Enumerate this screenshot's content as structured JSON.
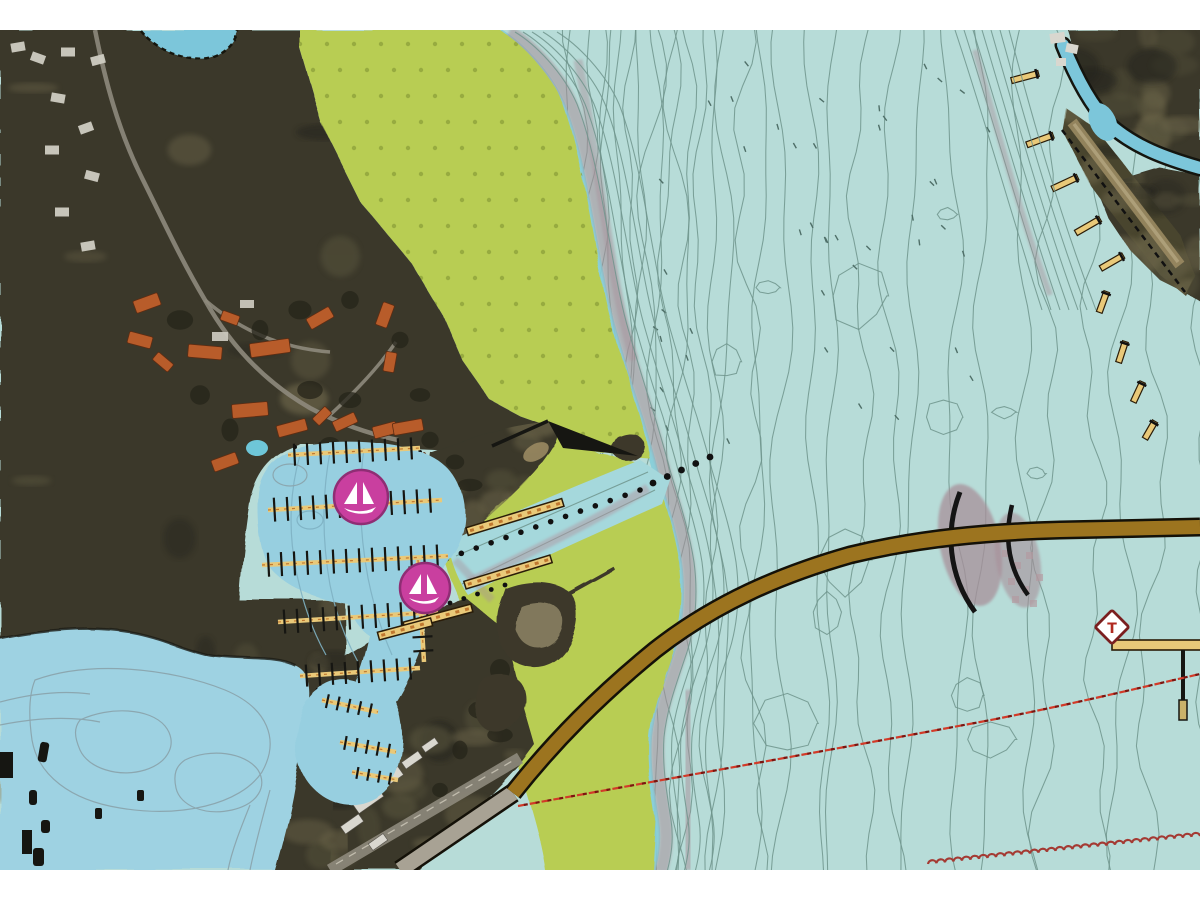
{
  "window": {
    "background": "#ffffff",
    "map_top_margin": 30,
    "map_height": 840,
    "map_width": 1200
  },
  "map": {
    "kind_name": "nautical-chart-overlay-on-satellite-imagery",
    "visible_text": [
      "T"
    ]
  },
  "palette": {
    "water_open": "#b7dcd8",
    "water_lagoon": "#9ed2e2",
    "water_marina": "#97cfe0",
    "water_channel": "#a5d8dc",
    "water_creek": "#7cc6da",
    "contour": "#6f948c",
    "contour_soft": "#8aa3ab",
    "drying_flat_green": "#b8cd52",
    "drying_dots": "#8fa23c",
    "shoal_mauve": "#a8909a",
    "land_dark": "#3a382a",
    "land_light": "#6a6448",
    "land_shadow": "#23211a",
    "beach_tan": "#9a8a62",
    "causeway_brown": "#9c741f",
    "causeway_edge": "#141108",
    "pier_fill": "#e9c979",
    "pier_edge": "#2a1c08",
    "pier_rung": "#c07830",
    "dock_black": "#161612",
    "marina_magenta": "#c93f9f",
    "marina_rim": "#8f2d74",
    "marina_white": "#ffffff",
    "beacon_fill": "#ffffff",
    "beacon_border": "#7a1f1f",
    "beacon_letter": "#b02a20",
    "cable_red": "#d23a28",
    "cable_dark": "#7a1510",
    "overhead_wavy": "#a43a33",
    "roof_orange": "#b85c2a",
    "building_white": "#d9d7cf",
    "road_gray": "#8e897c",
    "pool_blue": "#6ec6d8",
    "bright_rim": "#85cdd9"
  },
  "symbols": {
    "marina_count": 2,
    "marina_icon": "sailboat-in-magenta-circle",
    "beacon": {
      "label": "T",
      "icon": "restriction-diamond"
    },
    "cable_icon": "red-dashed-cable-line",
    "overhead_icon": "red-wavy-line",
    "pile_row_icon": "black-dotted-pile-line",
    "jetty_icon": "black-jetty",
    "dock_icon": "tan-pier"
  }
}
